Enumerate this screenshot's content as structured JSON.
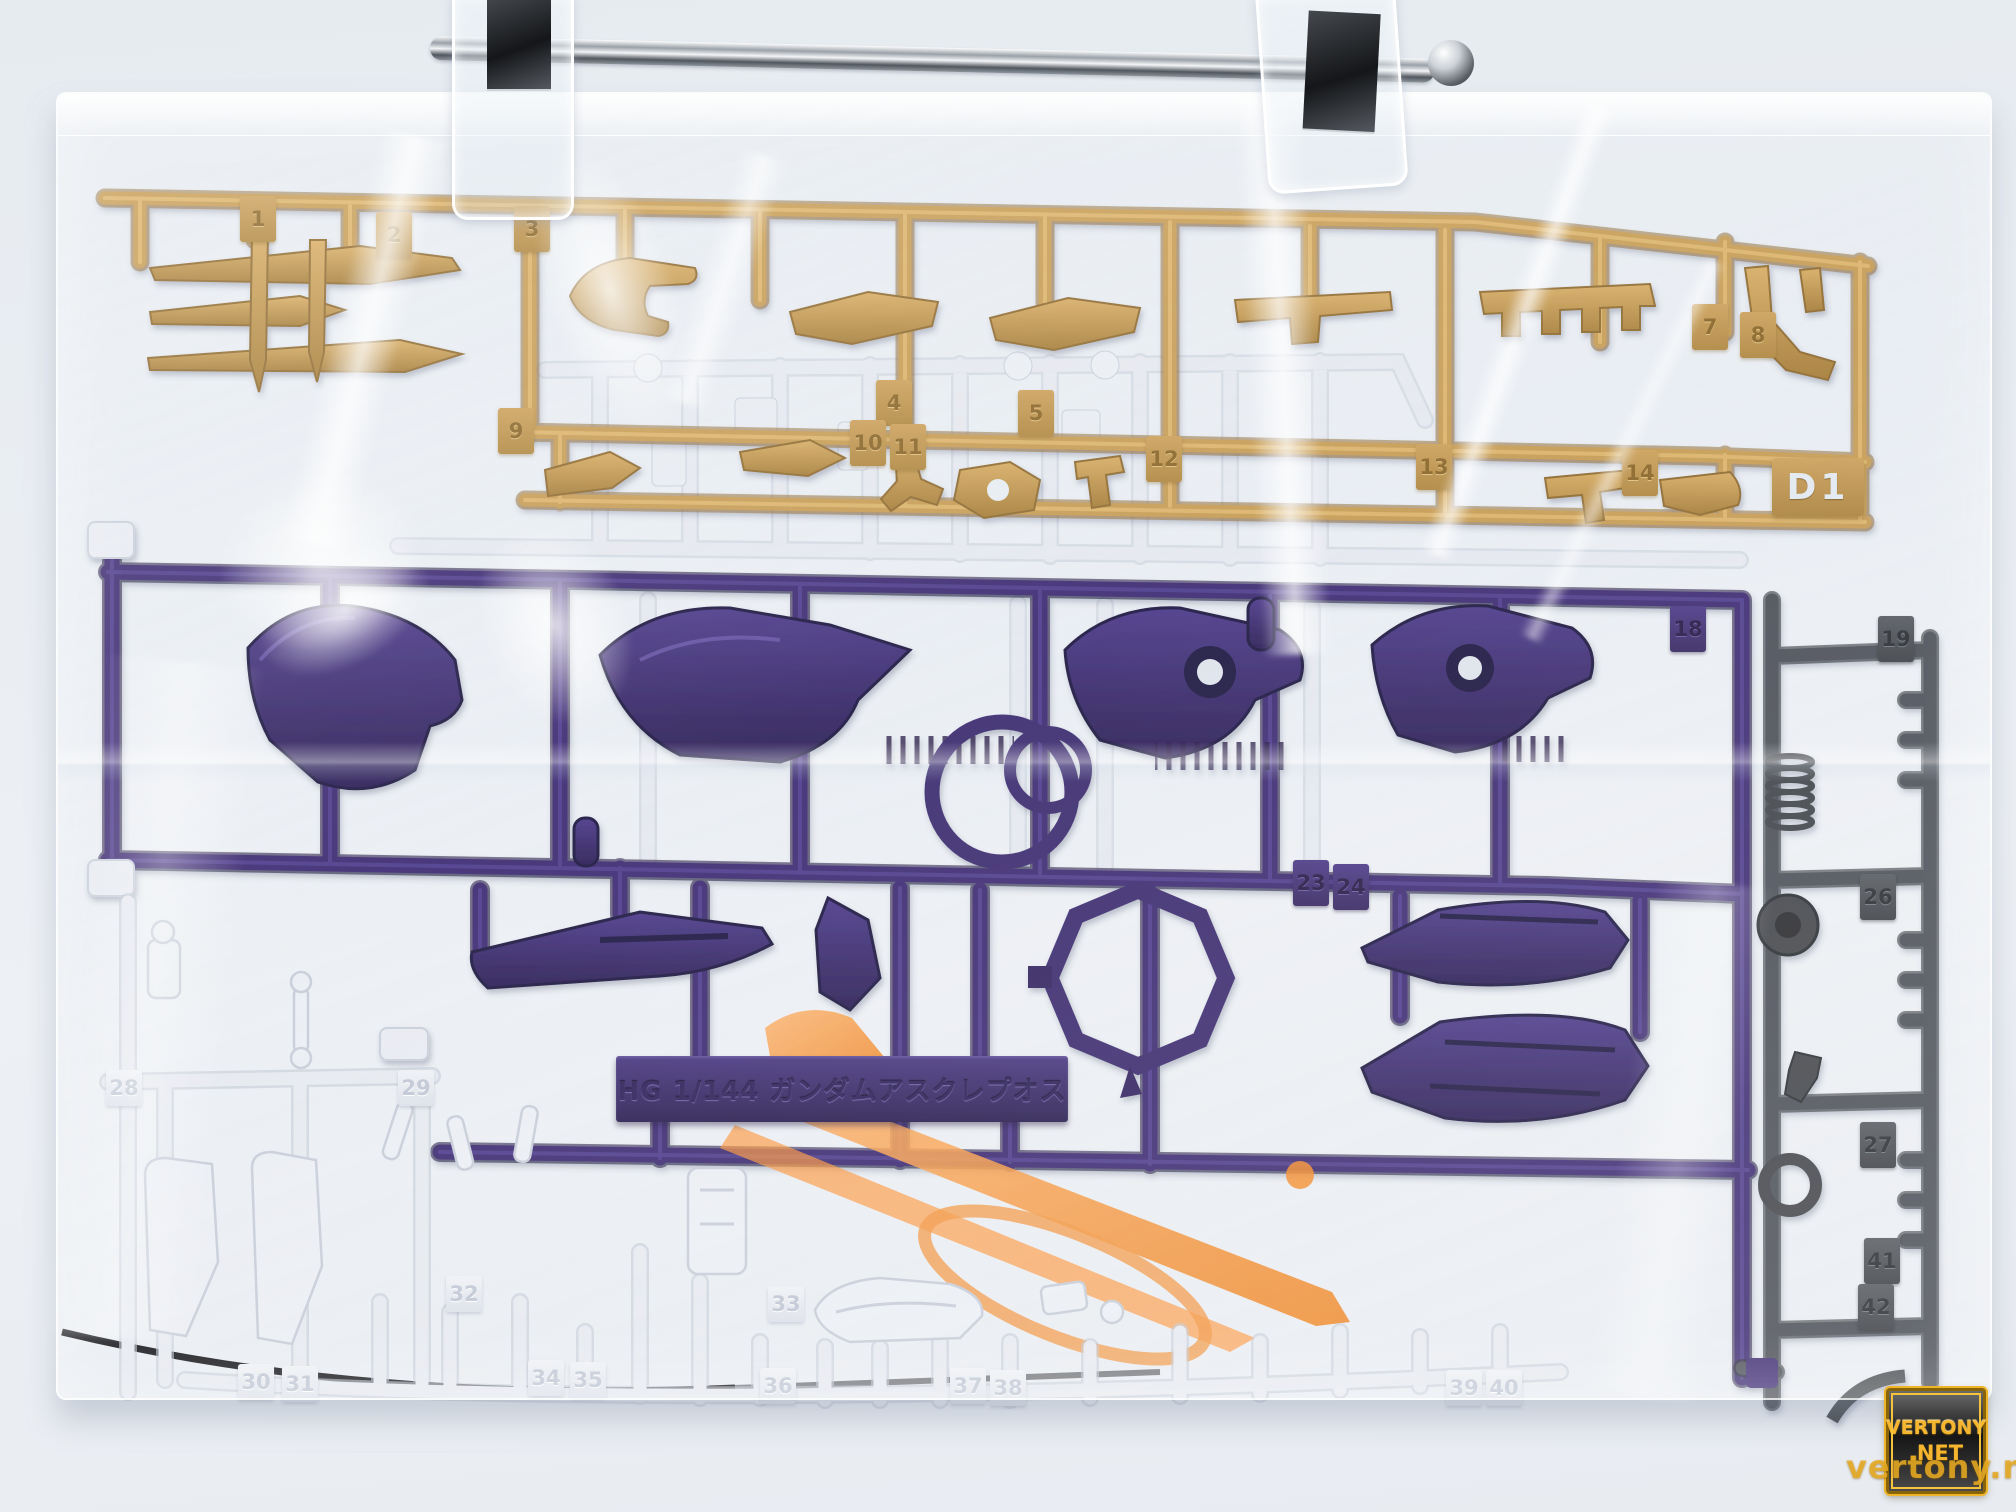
{
  "runner_tag": {
    "code": "D1"
  },
  "nameplate": {
    "molded_text": "HG 1/144 ガンダムアスクレプオス"
  },
  "watermark": {
    "title_line1": "VERTONY",
    "title_line2": ".NET",
    "url_text": "vertony.net"
  },
  "part_numbers": {
    "gold": [
      "1",
      "2",
      "3",
      "4",
      "5",
      "7",
      "8",
      "9",
      "10",
      "11",
      "12",
      "13",
      "14"
    ],
    "purple": [
      "18",
      "23",
      "24"
    ],
    "gray": [
      "19",
      "26",
      "27",
      "41",
      "42"
    ],
    "white": [
      "28",
      "29",
      "30",
      "31",
      "32",
      "33",
      "34",
      "35",
      "36",
      "37",
      "38",
      "39",
      "40"
    ]
  },
  "colors": {
    "gold_runner": "#c49a52",
    "purple_runner": "#3a2a6e",
    "gray_runner": "#45494e",
    "orange_runner": "#ff8a2e",
    "white_runner": "#e7eaf0",
    "watermark_gold": "#f0b428"
  }
}
